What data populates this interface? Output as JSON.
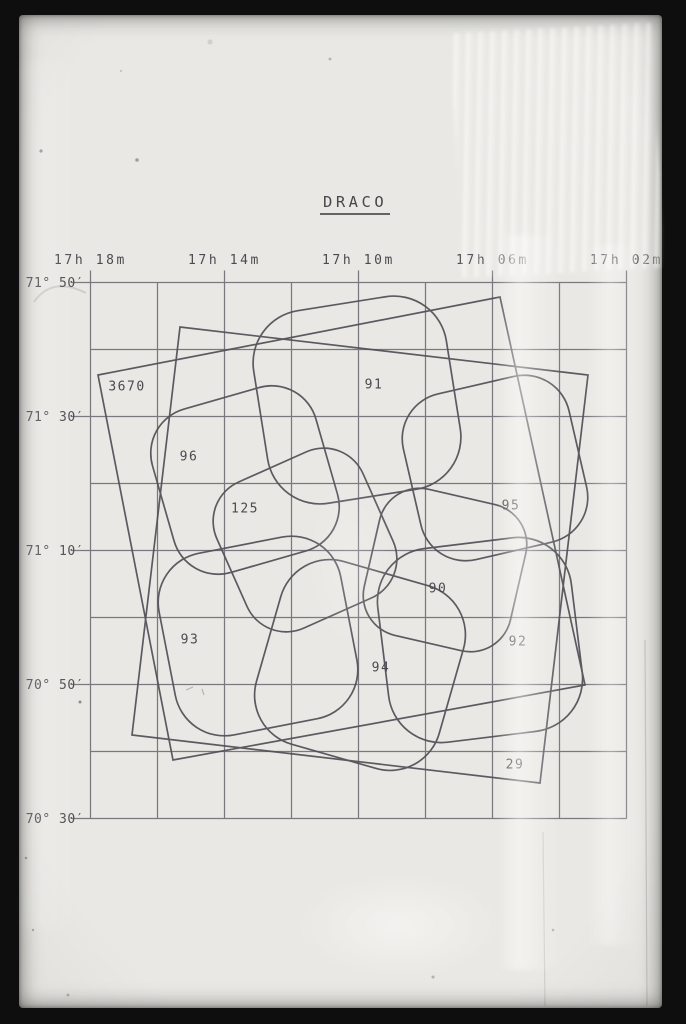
{
  "title": {
    "text": "DRACO"
  },
  "colors": {
    "paper": "#e9e8e4",
    "frame": "#0e0e0e",
    "grid": "#696970",
    "outline": "#4f4f56",
    "text": "#4a4a50"
  },
  "chart_data": {
    "type": "map",
    "title": "DRACO",
    "description": "Constellation finding chart with equatorial coordinate grid and overlapping survey field outlines",
    "grid": {
      "x_min": 90.5,
      "x_max": 626.5,
      "y_min": 282.5,
      "y_max": 818.5,
      "x_step": 67,
      "y_step": 67,
      "x_count": 9,
      "y_count": 9,
      "tick_above": 12,
      "tick_left": 19
    },
    "ra_ticks": [
      {
        "label": "17h 18m",
        "x": 90.5
      },
      {
        "label": "17h 14m",
        "x": 224.5
      },
      {
        "label": "17h 10m",
        "x": 358.5
      },
      {
        "label": "17h 06m",
        "x": 492.5
      },
      {
        "label": "17h 02m",
        "x": 626.5
      }
    ],
    "dec_ticks": [
      {
        "label": "71° 50′",
        "y": 282.5
      },
      {
        "label": "71° 30′",
        "y": 416.5
      },
      {
        "label": "71° 10′",
        "y": 550.5
      },
      {
        "label": "70° 50′",
        "y": 684.5
      },
      {
        "label": "70° 30′",
        "y": 818.5
      }
    ],
    "ra_label_y": 264,
    "dec_label_x": 84,
    "fields": [
      {
        "label": "3670",
        "shape": "quad",
        "points": [
          [
            98,
            375
          ],
          [
            500,
            297
          ],
          [
            585,
            685
          ],
          [
            173,
            760
          ]
        ],
        "label_pos": [
          127,
          386
        ]
      },
      {
        "label": "29",
        "shape": "quad",
        "points": [
          [
            180,
            327
          ],
          [
            588,
            375
          ],
          [
            540,
            783
          ],
          [
            132,
            735
          ]
        ],
        "label_pos": [
          515,
          764
        ]
      },
      {
        "label": "91",
        "shape": "rounded",
        "cx": 357,
        "cy": 400,
        "side": 195,
        "rot": -9,
        "label_pos": [
          374,
          384
        ]
      },
      {
        "label": "96",
        "shape": "rounded",
        "cx": 245,
        "cy": 480,
        "side": 170,
        "rot": -16,
        "label_pos": [
          189,
          456
        ]
      },
      {
        "label": "125",
        "shape": "rounded",
        "cx": 305,
        "cy": 540,
        "side": 160,
        "rot": -24,
        "label_pos": [
          245,
          508
        ]
      },
      {
        "label": "95",
        "shape": "rounded",
        "cx": 495,
        "cy": 468,
        "side": 170,
        "rot": -13,
        "label_pos": [
          511,
          505
        ]
      },
      {
        "label": "90",
        "shape": "rounded",
        "cx": 445,
        "cy": 570,
        "side": 150,
        "rot": 13,
        "label_pos": [
          438,
          588
        ]
      },
      {
        "label": "93",
        "shape": "rounded",
        "cx": 258,
        "cy": 636,
        "side": 185,
        "rot": -11,
        "label_pos": [
          190,
          639
        ]
      },
      {
        "label": "94",
        "shape": "rounded",
        "cx": 360,
        "cy": 665,
        "side": 190,
        "rot": 16,
        "label_pos": [
          381,
          667
        ]
      },
      {
        "label": "92",
        "shape": "rounded",
        "cx": 480,
        "cy": 640,
        "side": 195,
        "rot": -7,
        "label_pos": [
          518,
          641
        ]
      }
    ]
  }
}
